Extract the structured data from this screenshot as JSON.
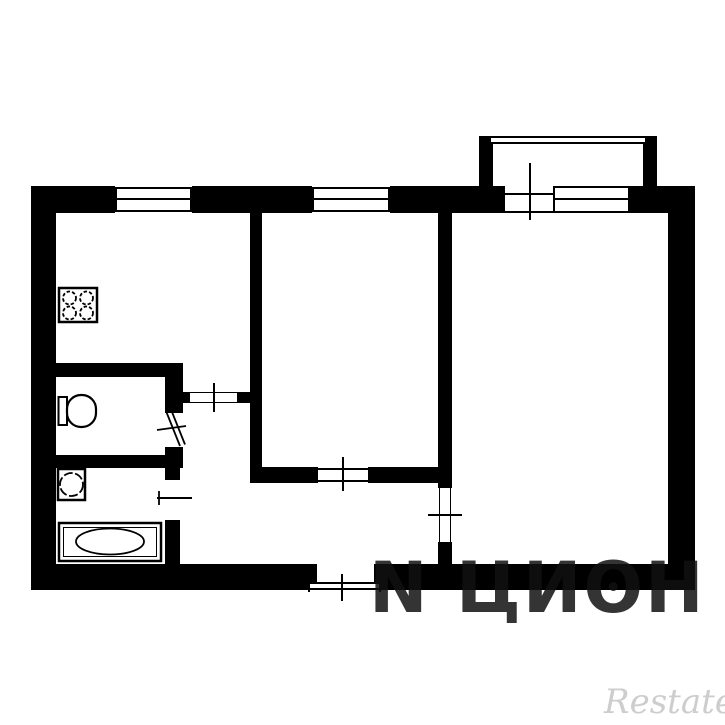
{
  "meta": {
    "title": "Two-room apartment floor plan",
    "diagram_type": "floor-plan",
    "rooms": [
      "kitchen",
      "living-room",
      "bedroom",
      "toilet",
      "bathroom",
      "hallway",
      "balcony"
    ],
    "window_count": 3,
    "door_count": 7
  },
  "watermarks": {
    "cian": "N ЦИʘН",
    "restate": "Restate"
  },
  "palette": {
    "walls": "#000000",
    "background": "#ffffff",
    "cian_text": "rgba(16,16,16,0.85)",
    "restate_text": "#cdcdcd"
  },
  "fixtures": [
    {
      "name": "stove",
      "location": "kitchen"
    },
    {
      "name": "toilet",
      "location": "toilet-room"
    },
    {
      "name": "sink",
      "location": "bathroom"
    },
    {
      "name": "bathtub",
      "location": "bathroom"
    }
  ]
}
